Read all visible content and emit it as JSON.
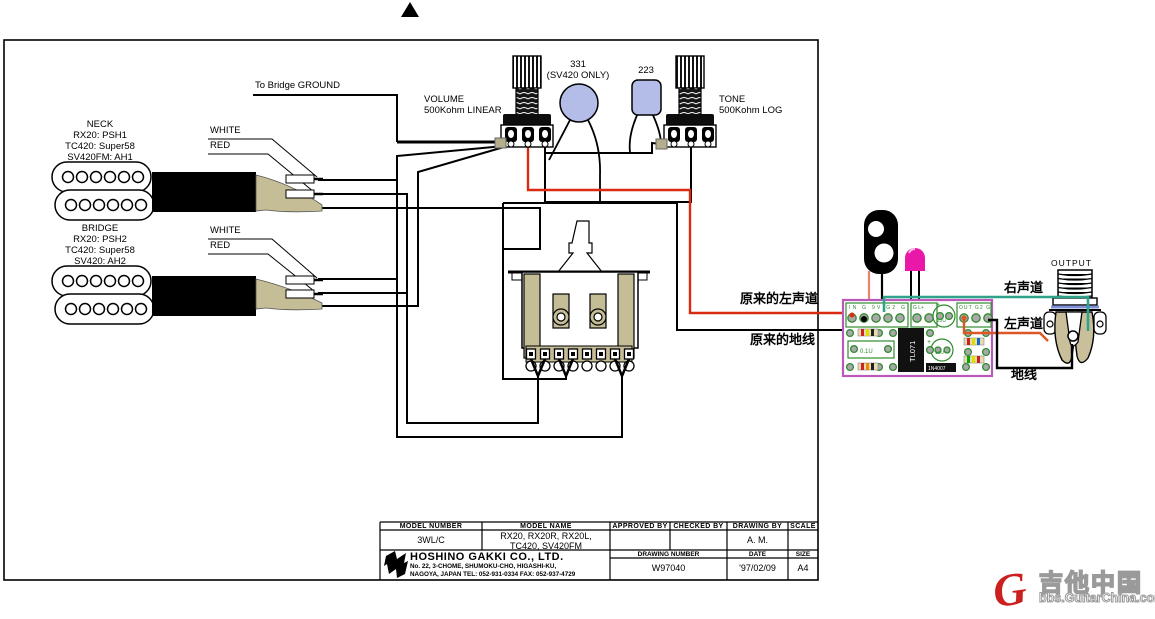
{
  "frame": {
    "orientation_mark": "▲"
  },
  "ground_note": "To Bridge GROUND",
  "pickups": {
    "neck": {
      "labels": [
        "NECK",
        "RX20: PSH1",
        "TC420: Super58",
        "SV420FM: AH1"
      ],
      "wire1": "WHITE",
      "wire2": "RED"
    },
    "bridge": {
      "labels": [
        "BRIDGE",
        "RX20: PSH2",
        "TC420: Super58",
        "SV420: AH2"
      ],
      "wire1": "WHITE",
      "wire2": "RED"
    }
  },
  "pots": {
    "volume": {
      "name": "VOLUME",
      "value": "500Kohm LINEAR"
    },
    "tone": {
      "name": "TONE",
      "value": "500Kohm LOG"
    }
  },
  "caps": {
    "cap331": {
      "value": "331",
      "note": "(SV420 ONLY)"
    },
    "cap223": {
      "value": "223"
    }
  },
  "pcb": {
    "pads_left": "IN G 9V G2 G",
    "pads_mid": "G L+",
    "pads_right": "OUT G2 G",
    "cap_top": "22U",
    "cap_film": "0.1U",
    "cap_lower": "10U",
    "ic": "TL071",
    "diode": "1N4007",
    "plus1": "+",
    "plus2": "+"
  },
  "output": {
    "label": "OUTPUT"
  },
  "cn_labels": {
    "orig_left_channel": "原来的左声道",
    "orig_ground": "原来的地线",
    "right_channel": "右声道",
    "left_channel": "左声道",
    "ground": "地线"
  },
  "title_block": {
    "headers": [
      "MODEL NUMBER",
      "MODEL NAME",
      "APPROVED BY",
      "CHECKED BY",
      "DRAWING BY",
      "SCALE"
    ],
    "model_number": "3WL/C",
    "model_name_line1": "RX20, RX20R, RX20L,",
    "model_name_line2": "TC420, SV420FM",
    "drawing_by": "A. M.",
    "company": "HOSHINO GAKKI CO., LTD.",
    "address_line1": "No. 22, 3-CHOME, SHUMOKU-CHO, HIGASHI-KU,",
    "address_line2": "NAGOYA, JAPAN    TEL: 052-931-0334   FAX: 052-937-4729",
    "sub_headers": {
      "drawing_number": "DRAWING NUMBER",
      "date": "DATE",
      "size": "SIZE"
    },
    "drawing_number": "W97040",
    "date": "'97/02/09",
    "size": "A4"
  },
  "watermark": {
    "g": "G",
    "cn": "吉他中国",
    "url": "bbs.GuitarChina.com"
  },
  "colors": {
    "wire_red": "#d92b11",
    "wire_teal": "#2fa28b",
    "wire_orange": "#e05525",
    "wire_batt_red": "#ef8070",
    "led_magenta": "#ea18a8",
    "cap_lavender": "#b4bce8",
    "tan": "#c5bd96",
    "pcb_border": "#bb58bb",
    "pcb_green": "#2e8b2e"
  }
}
